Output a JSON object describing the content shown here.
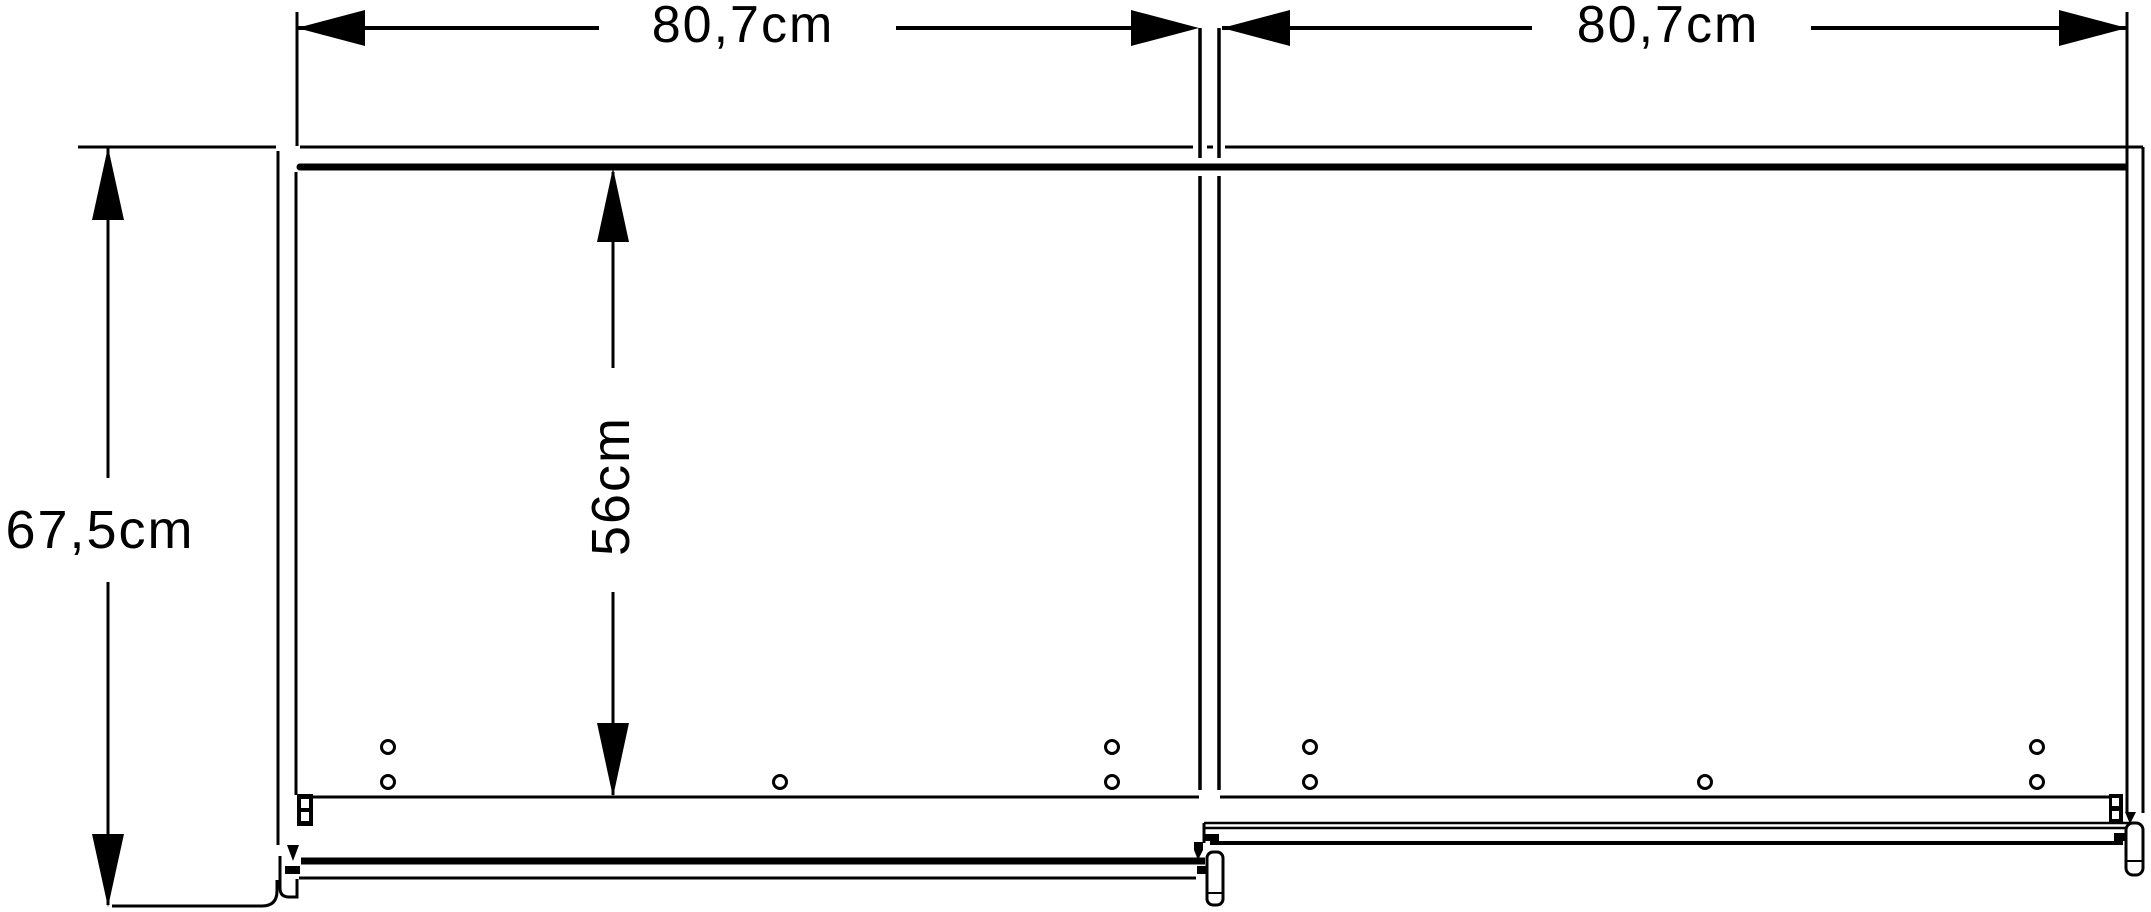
{
  "diagram": {
    "labels": {
      "width_left": "80,7cm",
      "width_right": "80,7cm",
      "depth_total": "67,5cm",
      "depth_interior": "56cm"
    },
    "colors": {
      "line": "#000000",
      "background": "#ffffff"
    }
  }
}
